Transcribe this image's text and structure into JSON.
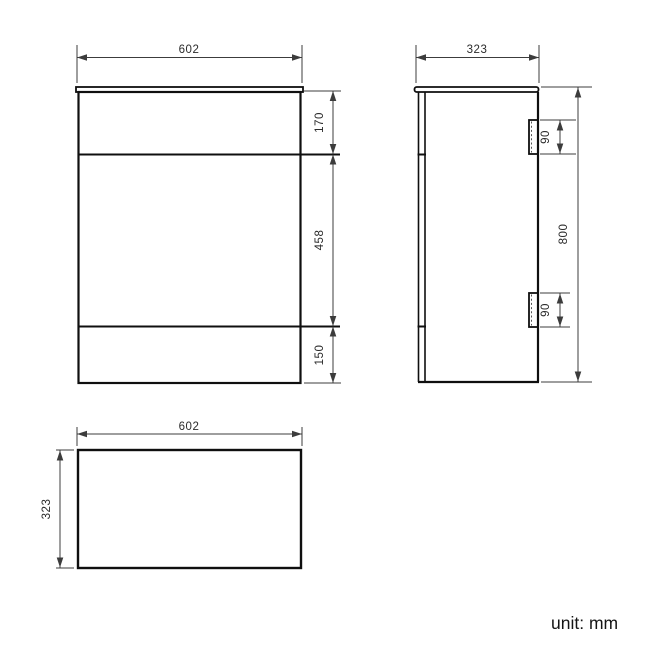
{
  "page": {
    "unit_label": "unit: mm",
    "background_color": "#ffffff"
  },
  "colors": {
    "cabinet_outline": "#0f0f0f",
    "dimension_lines": "#3c3c3c",
    "dimension_text": "#2b2b2b"
  },
  "front_view": {
    "width_mm": "602",
    "top_panel_mm": "170",
    "door_section_mm": "458",
    "plinth_mm": "150"
  },
  "side_view": {
    "depth_mm": "323",
    "height_mm": "800",
    "top_bracket_mm": "90",
    "bottom_bracket_mm": "90"
  },
  "top_view": {
    "width_mm": "602",
    "depth_mm": "323"
  }
}
